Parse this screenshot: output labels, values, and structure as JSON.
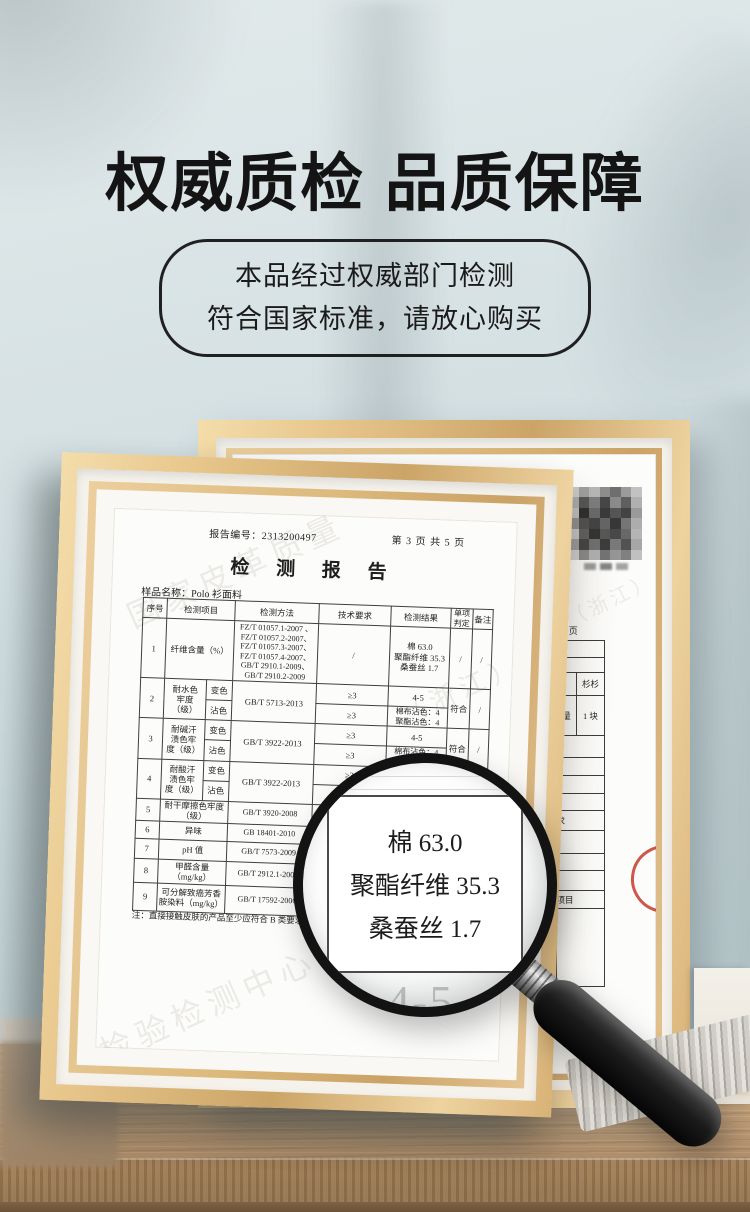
{
  "header": {
    "title": "权威质检 品质保障",
    "badge": {
      "line1": "本品经过权威部门检测",
      "line2": "符合国家标准，请放心购买"
    }
  },
  "report": {
    "report_no_line": "报告编号：2313200497",
    "page_info": "第 3 页 共 5 页",
    "doc_title": "检 测 报 告",
    "sample_line": "样品名称：Polo 衫面料",
    "table": {
      "headers": {
        "no": "序号",
        "item": "检测项目",
        "method": "检测方法",
        "requirement": "技术要求",
        "result": "检测结果",
        "verdict": "单项\n判定",
        "remark": "备注"
      },
      "row1": {
        "no": "1",
        "item": "纤维含量（%）",
        "method": "FZ/T 01057.1-2007 、\nFZ/T 01057.2-2007、\nFZ/T 01057.3-2007、\nFZ/T 01057.4-2007、\nGB/T 2910.1-2009、\nGB/T 2910.2-2009",
        "requirement": "/",
        "result": "棉 63.0\n聚酯纤维 35.3\n桑蚕丝 1.7",
        "verdict": "/",
        "remark": "/"
      },
      "row2": {
        "no": "2",
        "item": "耐水色\n牢度\n（级）",
        "sub1": "变色",
        "sub2": "沾色",
        "method": "GB/T 5713-2013",
        "req1": "≥3",
        "req2": "≥3",
        "res1": "4-5",
        "res2": "棉布沾色：4\n聚酯沾色：4",
        "verdict": "符合",
        "remark": "/"
      },
      "row3": {
        "no": "3",
        "item": "耐碱汗\n渍色牢\n度（级）",
        "sub1": "变色",
        "sub2": "沾色",
        "method": "GB/T 3922-2013",
        "req1": "≥3",
        "req2": "≥3",
        "res1": "4-5",
        "res2": "棉布沾色：4\n聚酯沾色：4",
        "verdict": "符合",
        "remark": "/"
      },
      "row4": {
        "no": "4",
        "item": "耐酸汗\n渍色牢\n度（级）",
        "sub1": "变色",
        "sub2": "沾色",
        "method": "GB/T 3922-2013",
        "req1": "≥3",
        "req2": "",
        "res1": "",
        "res2": "",
        "verdict": "",
        "remark": ""
      },
      "row5": {
        "no": "5",
        "item": "耐干摩擦色牢度\n（级）",
        "method": "GB/T 3920-2008",
        "requirement": "",
        "result": "",
        "verdict": "",
        "remark": ""
      },
      "row6": {
        "no": "6",
        "item": "异味",
        "method": "GB 18401-2010",
        "requirement": "",
        "result": "",
        "verdict": "",
        "remark": ""
      },
      "row7": {
        "no": "7",
        "item": "pH 值",
        "method": "GB/T 7573-2009",
        "requirement": "",
        "result": "",
        "verdict": "",
        "remark": ""
      },
      "row8": {
        "no": "8",
        "item": "甲醛含量\n（mg/kg）",
        "method": "GB/T 2912.1-2009",
        "requirement": "",
        "result": "",
        "verdict": "",
        "remark": ""
      },
      "row9": {
        "no": "9",
        "item": "可分解致癌芳香\n胺染料（mg/kg）",
        "method": "GB/T 17592-2006",
        "requirement": "",
        "result": "",
        "verdict": "",
        "remark": ""
      }
    },
    "note": "注：直接接触皮肤的产品至少应符合 B 类要求",
    "watermarks": {
      "w1": "国家皮革质量",
      "w2": "检验检测中心",
      "w3": "（浙江）"
    }
  },
  "magnifier": {
    "line1": "棉 63.0",
    "line2": "聚酯纤维 35.3",
    "line3": "桑蚕丝 1.7",
    "underlay_value": "4-5"
  },
  "right_certificate": {
    "page_fragment": "5 页",
    "qty_prefix": "量",
    "brand_cell": "杉杉",
    "qty_cell": "1 块",
    "fragment1": "检测要求",
    "fragment2": "验室",
    "fragment3": "类",
    "fragment4": "、其余项目",
    "stamp_fragment": "质检",
    "watermark": "（浙江）",
    "mosaic_colors": [
      "#c8c8c8",
      "#9f9f9f",
      "#b7b7b7",
      "#8e8e8e",
      "#6f6f6f",
      "#9b9b9b",
      "#c2c2c2",
      "#a9a9a9",
      "#565656",
      "#7d7d7d",
      "#474747",
      "#8b8b8b",
      "#5f5f5f",
      "#b0b0b0",
      "#bdbdbd",
      "#2f2f2f",
      "#6a6a6a",
      "#3a3a3a",
      "#555555",
      "#434343",
      "#9a9a9a",
      "#8f8f8f",
      "#515151",
      "#444444",
      "#666666",
      "#383838",
      "#757575",
      "#adadad",
      "#c4c4c4",
      "#606060",
      "#343434",
      "#585858",
      "#494949",
      "#686868",
      "#b5b5b5",
      "#9c9c9c",
      "#454545",
      "#707070",
      "#3d3d3d",
      "#7a7a7a",
      "#525252",
      "#a6a6a6",
      "#cfcfcf",
      "#8a8a8a",
      "#b1b1b1",
      "#747474",
      "#969696",
      "#808080",
      "#c0c0c0"
    ],
    "caption_colors": [
      "#9a9a9a",
      "#858585",
      "#a3a3a3"
    ]
  },
  "colors": {
    "wall": "#cfdfe2",
    "frame_gold": "#d9b478",
    "wood": "#c2a17b",
    "stamp_red": "#c3392b",
    "magnifier_rim": "#131313",
    "headline_text": "#141414"
  }
}
